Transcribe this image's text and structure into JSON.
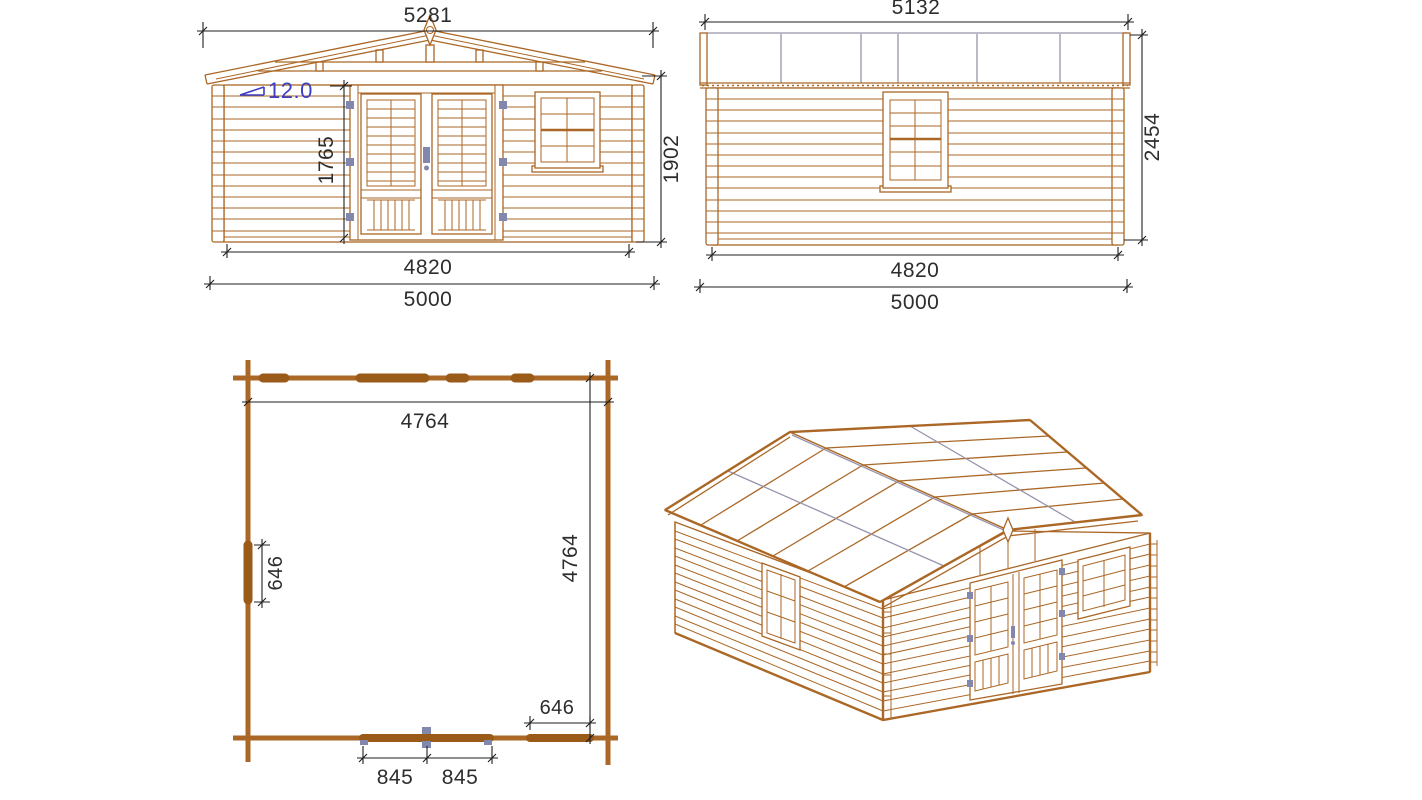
{
  "colors": {
    "paper": "#ffffff",
    "wood": "#ab6726",
    "wood_dark": "#9a5a18",
    "dim": "#1f1f1f",
    "text": "#2d2d2d",
    "blue": "#3b3fc4",
    "hinge": "#8287ad",
    "roofline": "#9793ab"
  },
  "front_view": {
    "dim_roof_width": "5281",
    "dim_roof_slope": "12.0",
    "dim_door_height": "1765",
    "dim_wall_height": "1902",
    "dim_wall_width": "4820",
    "dim_overall_width": "5000"
  },
  "side_view": {
    "dim_roof_length": "5132",
    "dim_overall_height": "2454",
    "dim_wall_length": "4820",
    "dim_overall_length": "5000"
  },
  "plan_view": {
    "dim_inner_width": "4764",
    "dim_inner_depth": "4764",
    "dim_side_window_width": "646",
    "dim_front_window_width": "646",
    "dim_door_leaf_left": "845",
    "dim_door_leaf_right": "845"
  }
}
